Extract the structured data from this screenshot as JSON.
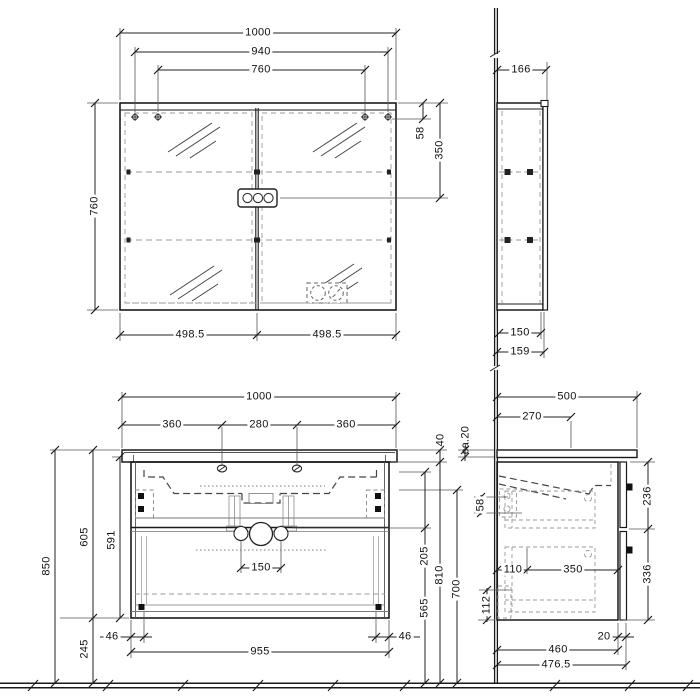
{
  "colors": {
    "line": "#1a1a1a",
    "hidden": "#888888",
    "dim_line": "#333333"
  },
  "dims": {
    "mirror_front": {
      "overall_width": "1000",
      "mounting_outer": "940",
      "mounting_inner": "760",
      "height": "760",
      "top_to_mount": "58",
      "top_to_switch": "350",
      "door_left": "498.5",
      "door_right": "498.5"
    },
    "mirror_side": {
      "overall_depth": "166",
      "body_depth": "150",
      "front_depth": "159"
    },
    "vanity_front": {
      "overall_width": "1000",
      "tap_left": "360",
      "tap_spacing": "280",
      "tap_right": "360",
      "height_total": "850",
      "height_unit": "605",
      "height_cabinet": "591",
      "floor_clearance": "245",
      "drain_spacing": "150",
      "bracket_inset_left": "46",
      "bracket_inset_right": "46",
      "cabinet_width": "955",
      "basin_rim": "40",
      "basin_to_drain": "205",
      "drain_height": "565",
      "underside_height": "810",
      "basin_bottom_height": "700"
    },
    "vanity_side": {
      "countertop_depth": "500",
      "tap_from_wall": "270",
      "countertop_thickness": "ca.20",
      "basin_back": "58",
      "service_space": "112",
      "runner_offset": "110",
      "runner_length": "350",
      "upper_front": "236",
      "lower_front": "336",
      "front_gap": "20",
      "body_depth": "460",
      "overall_depth": "476.5"
    }
  }
}
